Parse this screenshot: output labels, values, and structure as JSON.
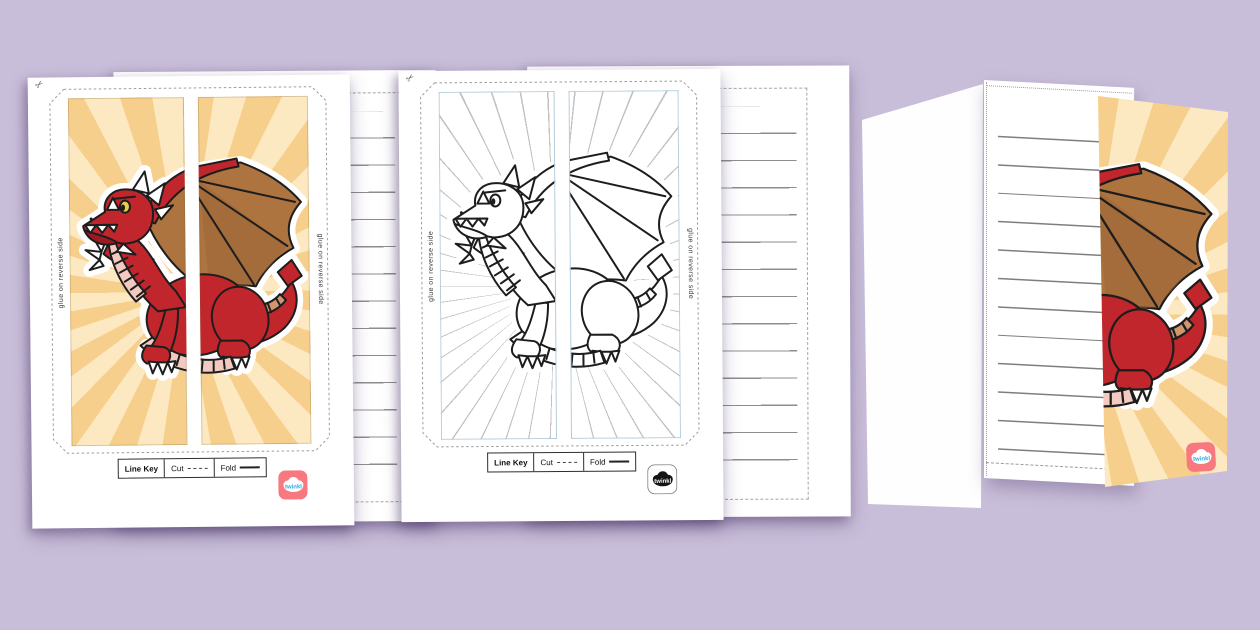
{
  "brand": {
    "logo_text": "twinkl",
    "badge_color": "#f8787f",
    "logo_text_color": "#2aa8e0"
  },
  "worksheet_colored": {
    "glue_note_left": "glue on reverse side",
    "glue_note_right": "glue on reverse side",
    "line_key": {
      "title": "Line Key",
      "cut_label": "Cut",
      "fold_label": "Fold"
    },
    "logo_text": "twinkl"
  },
  "worksheet_outline": {
    "glue_note_left": "glue on reverse side",
    "glue_note_right": "glue on reverse side",
    "line_key": {
      "title": "Line Key",
      "cut_label": "Cut",
      "fold_label": "Fold"
    },
    "logo_text": "twinkl"
  },
  "mockup": {
    "logo_text": "twinkl"
  },
  "colors": {
    "background": "#c9bed9",
    "sunburst_light": "#fce9c1",
    "sunburst_dark": "#f6cf8c",
    "dragon_red": "#c0262c",
    "wing_brown": "#ad7440",
    "belly_pink": "#f2cabf",
    "outline_panel_border": "#b5cddc",
    "ruled_line": "#8a8a8a",
    "twinkl_pink": "#f8787f"
  }
}
